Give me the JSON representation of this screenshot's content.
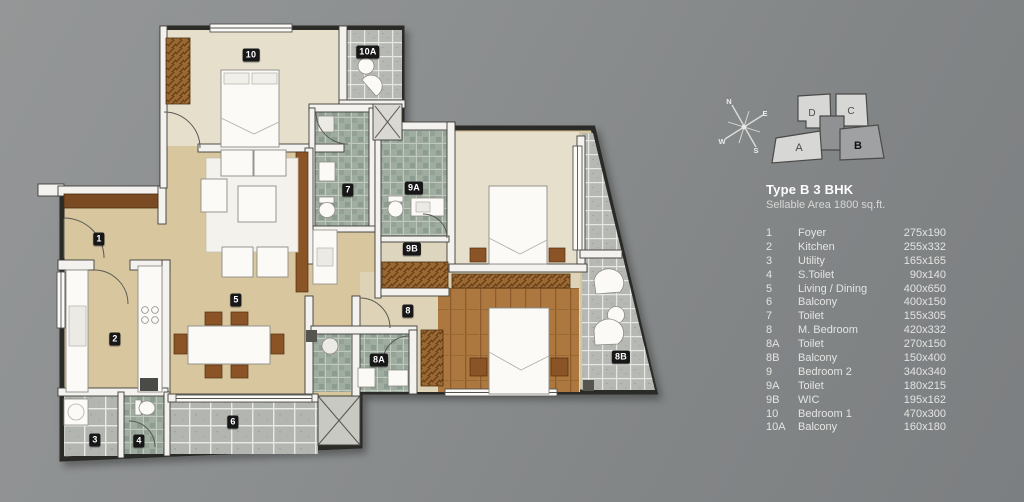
{
  "legend": {
    "title": "Type B 3 BHK",
    "subtitle": "Sellable Area 1800 sq.ft.",
    "rows": [
      {
        "id": "1",
        "name": "Foyer",
        "dims": "275x190"
      },
      {
        "id": "2",
        "name": "Kitchen",
        "dims": "255x332"
      },
      {
        "id": "3",
        "name": "Utility",
        "dims": "165x165"
      },
      {
        "id": "4",
        "name": "S.Toilet",
        "dims": "90x140"
      },
      {
        "id": "5",
        "name": "Living / Dining",
        "dims": "400x650"
      },
      {
        "id": "6",
        "name": "Balcony",
        "dims": "400x150"
      },
      {
        "id": "7",
        "name": "Toilet",
        "dims": "155x305"
      },
      {
        "id": "8",
        "name": "M. Bedroom",
        "dims": "420x332"
      },
      {
        "id": "8A",
        "name": "Toilet",
        "dims": "270x150"
      },
      {
        "id": "8B",
        "name": "Balcony",
        "dims": "150x400"
      },
      {
        "id": "9",
        "name": "Bedroom 2",
        "dims": "340x340"
      },
      {
        "id": "9A",
        "name": "Toilet",
        "dims": "180x215"
      },
      {
        "id": "9B",
        "name": "WIC",
        "dims": "195x162"
      },
      {
        "id": "10",
        "name": "Bedroom 1",
        "dims": "470x300"
      },
      {
        "id": "10A",
        "name": "Balcony",
        "dims": "160x180"
      }
    ]
  },
  "chips": [
    "1",
    "2",
    "3",
    "4",
    "5",
    "6",
    "7",
    "8",
    "8A",
    "8B",
    "9A",
    "9B",
    "10",
    "10A"
  ],
  "compass": {
    "n": "N",
    "e": "E",
    "s": "S",
    "w": "W"
  },
  "keyplan": {
    "a": "A",
    "b": "B",
    "c": "C",
    "d": "D",
    "highlighted": "B"
  },
  "colors": {
    "background": "#8a8d8e",
    "floor_beige": "#d7c69e",
    "floor_bedroom": "#e6dfcc",
    "floor_wood": "#ad7840",
    "tile_balcony": "#b6b9b3",
    "tile_toilet": "#9fada0",
    "wall_white": "#f3f2ee",
    "wall_dark": "#2c2b28",
    "chip_bg": "#171717",
    "legend_text": "#e4e5e3",
    "wardrobe_brown": "#9b6832"
  }
}
